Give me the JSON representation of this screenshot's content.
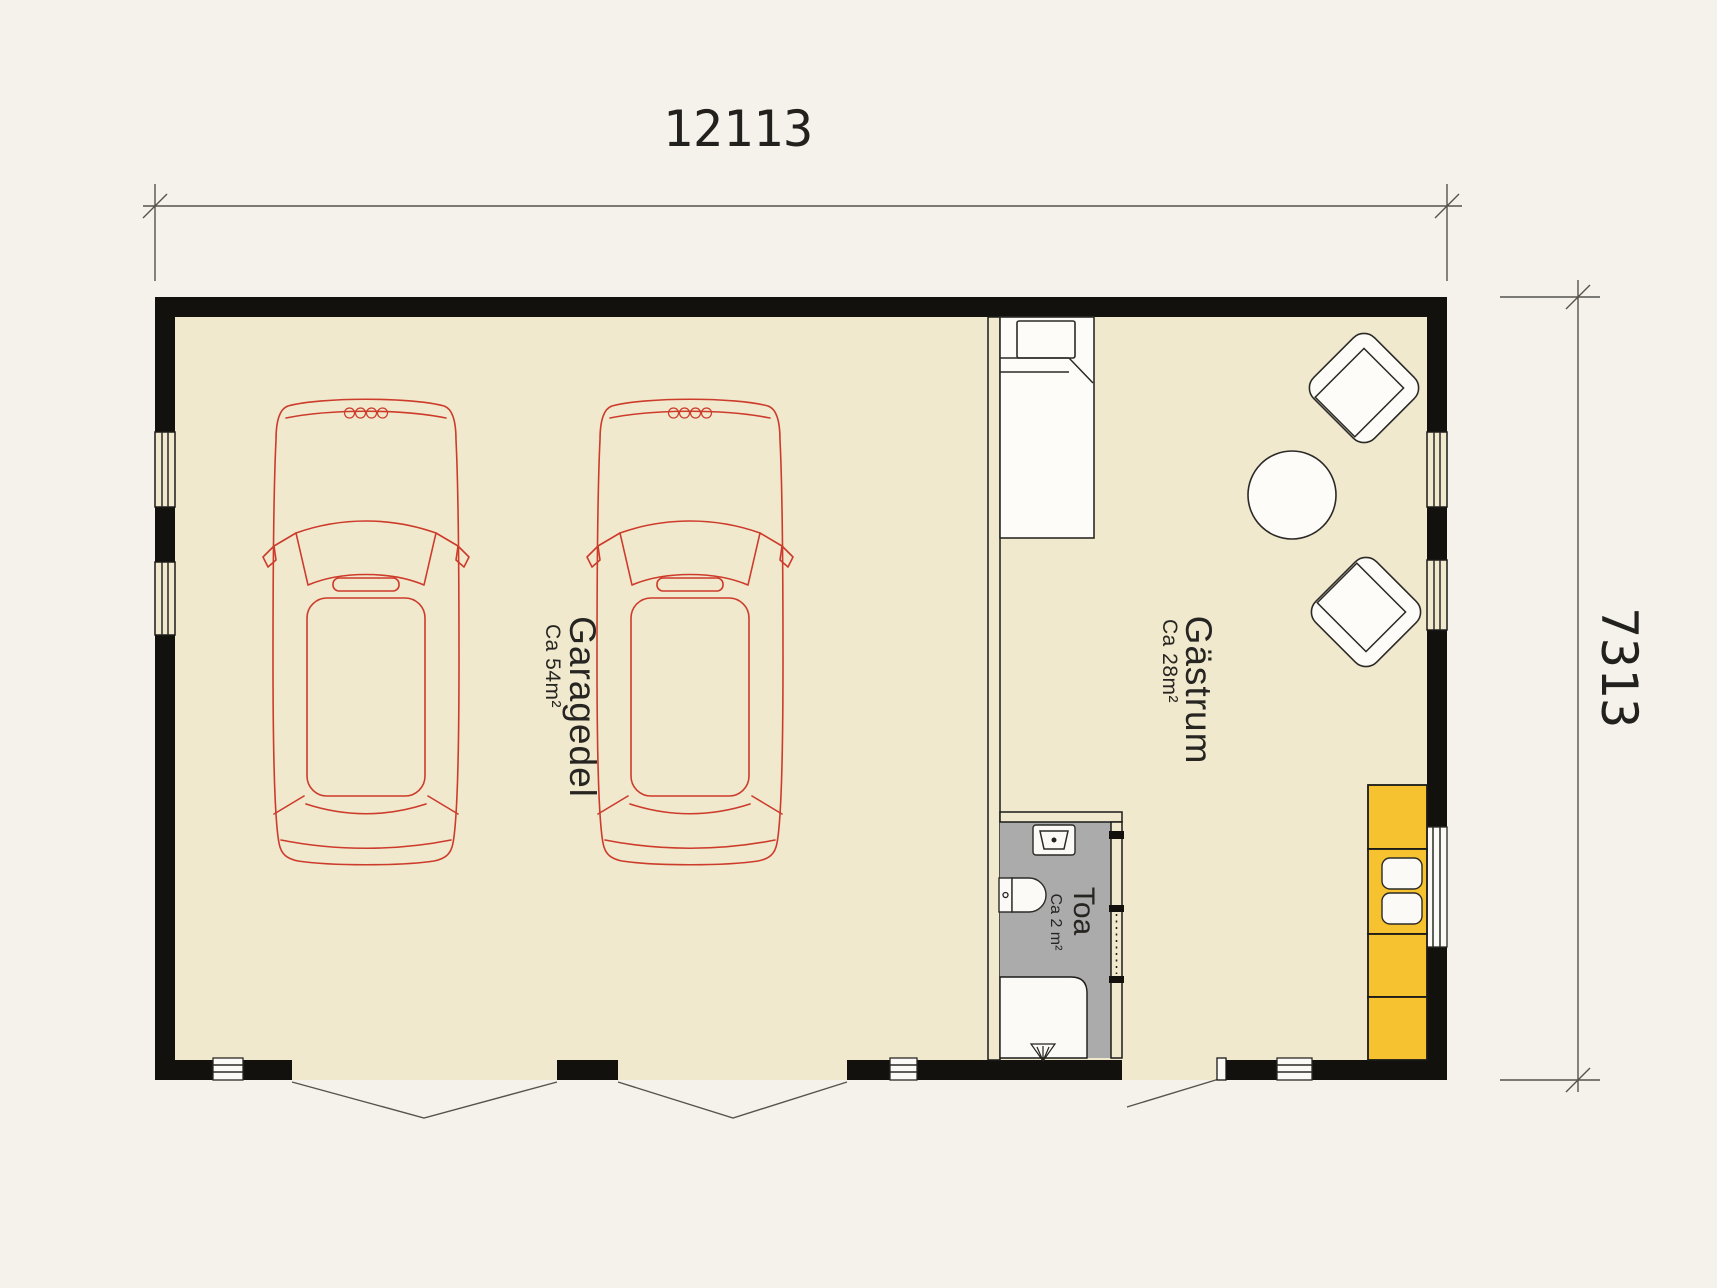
{
  "plan": {
    "dimensions": {
      "width_mm": "12113",
      "depth_mm": "7313"
    },
    "rooms": [
      {
        "id": "garage",
        "name": "Garagedel",
        "area": "Ca 54m²"
      },
      {
        "id": "guest",
        "name": "Gästrum",
        "area": "Ca 28m²"
      },
      {
        "id": "toilet",
        "name": "Toa",
        "area": "Ca 2 m²"
      }
    ]
  },
  "colors": {
    "bg": "#f4f2ea",
    "floor": "#f0e9cd",
    "wall": "#12110e",
    "ink": "#55534c",
    "label": "#262522",
    "car": "#cd3b2b",
    "accent": "#f6c22f",
    "wet": "#ababab",
    "white": "#fbfaf6"
  }
}
